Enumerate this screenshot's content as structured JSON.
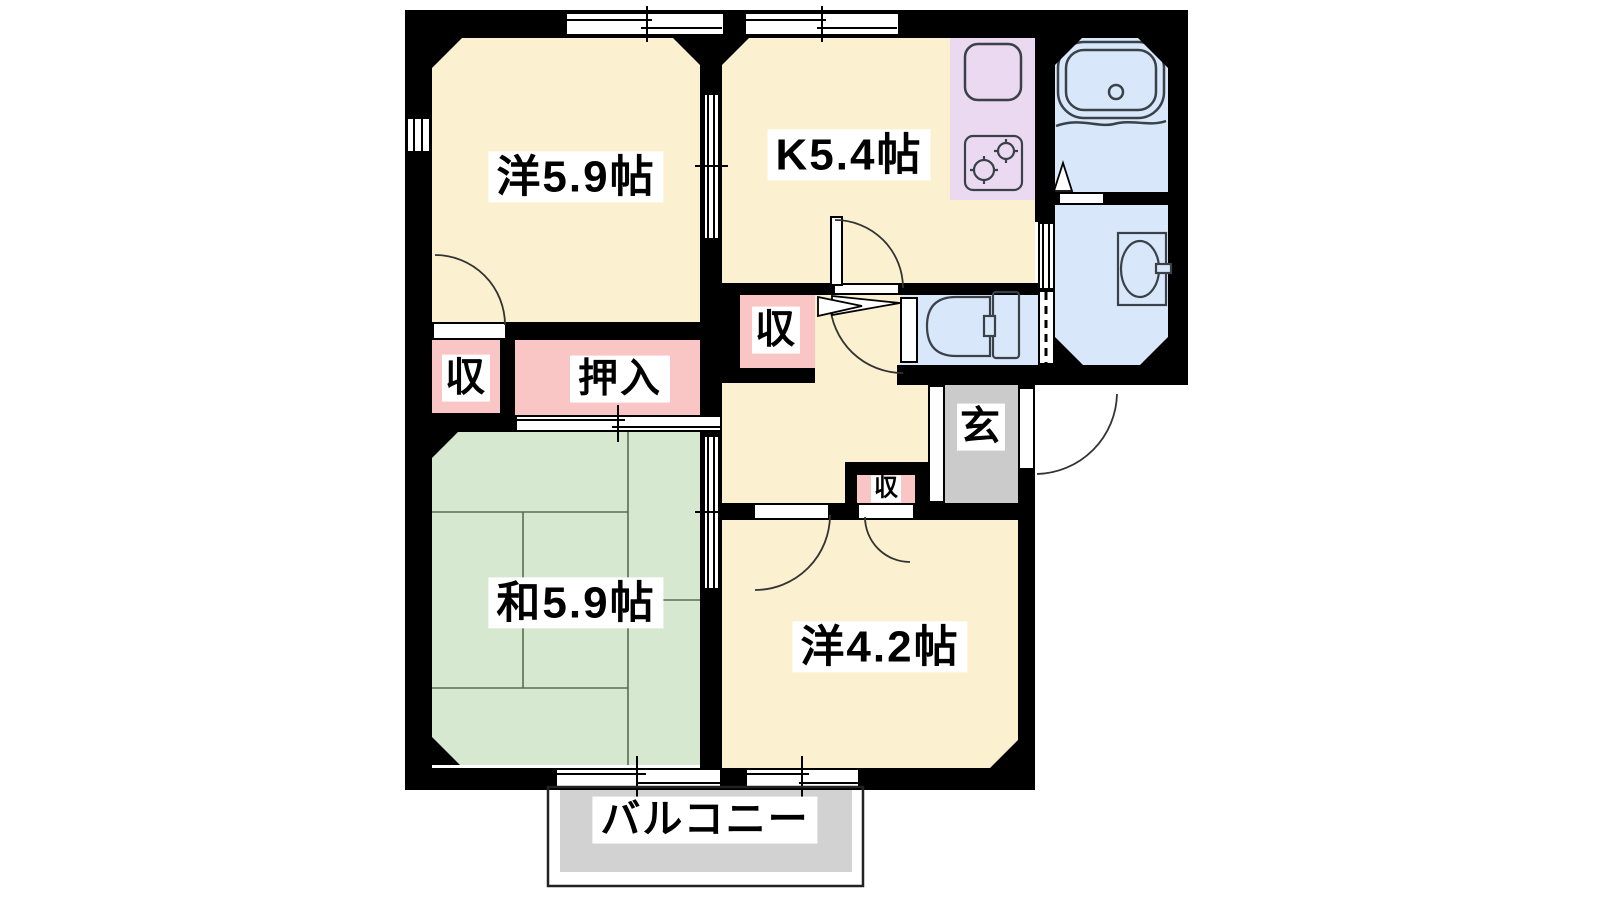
{
  "floorplan": {
    "rooms": {
      "western_5_9": {
        "label": "洋5.9帖"
      },
      "kitchen": {
        "label": "K5.4帖"
      },
      "japanese_5_9": {
        "label": "和5.9帖"
      },
      "western_4_2": {
        "label": "洋4.2帖"
      },
      "entrance": {
        "label": "玄"
      },
      "balcony": {
        "label": "バルコニー"
      }
    },
    "closets": {
      "bedroom_closet": {
        "label": "収"
      },
      "hall_closet": {
        "label": "収"
      },
      "small_closet": {
        "label": "収"
      },
      "oshiire": {
        "label": "押入"
      }
    },
    "colors": {
      "room_cream": "#FBF0CF",
      "tatami_green": "#D6E8D0",
      "wet_area_blue": "#D8E7F9",
      "closet_pink": "#F9C5C5",
      "counter_lavender": "#EAD9F1",
      "entrance_gray": "#CBCBCB",
      "balcony_gray": "#D2D2D2",
      "wall_black": "#000000"
    }
  }
}
